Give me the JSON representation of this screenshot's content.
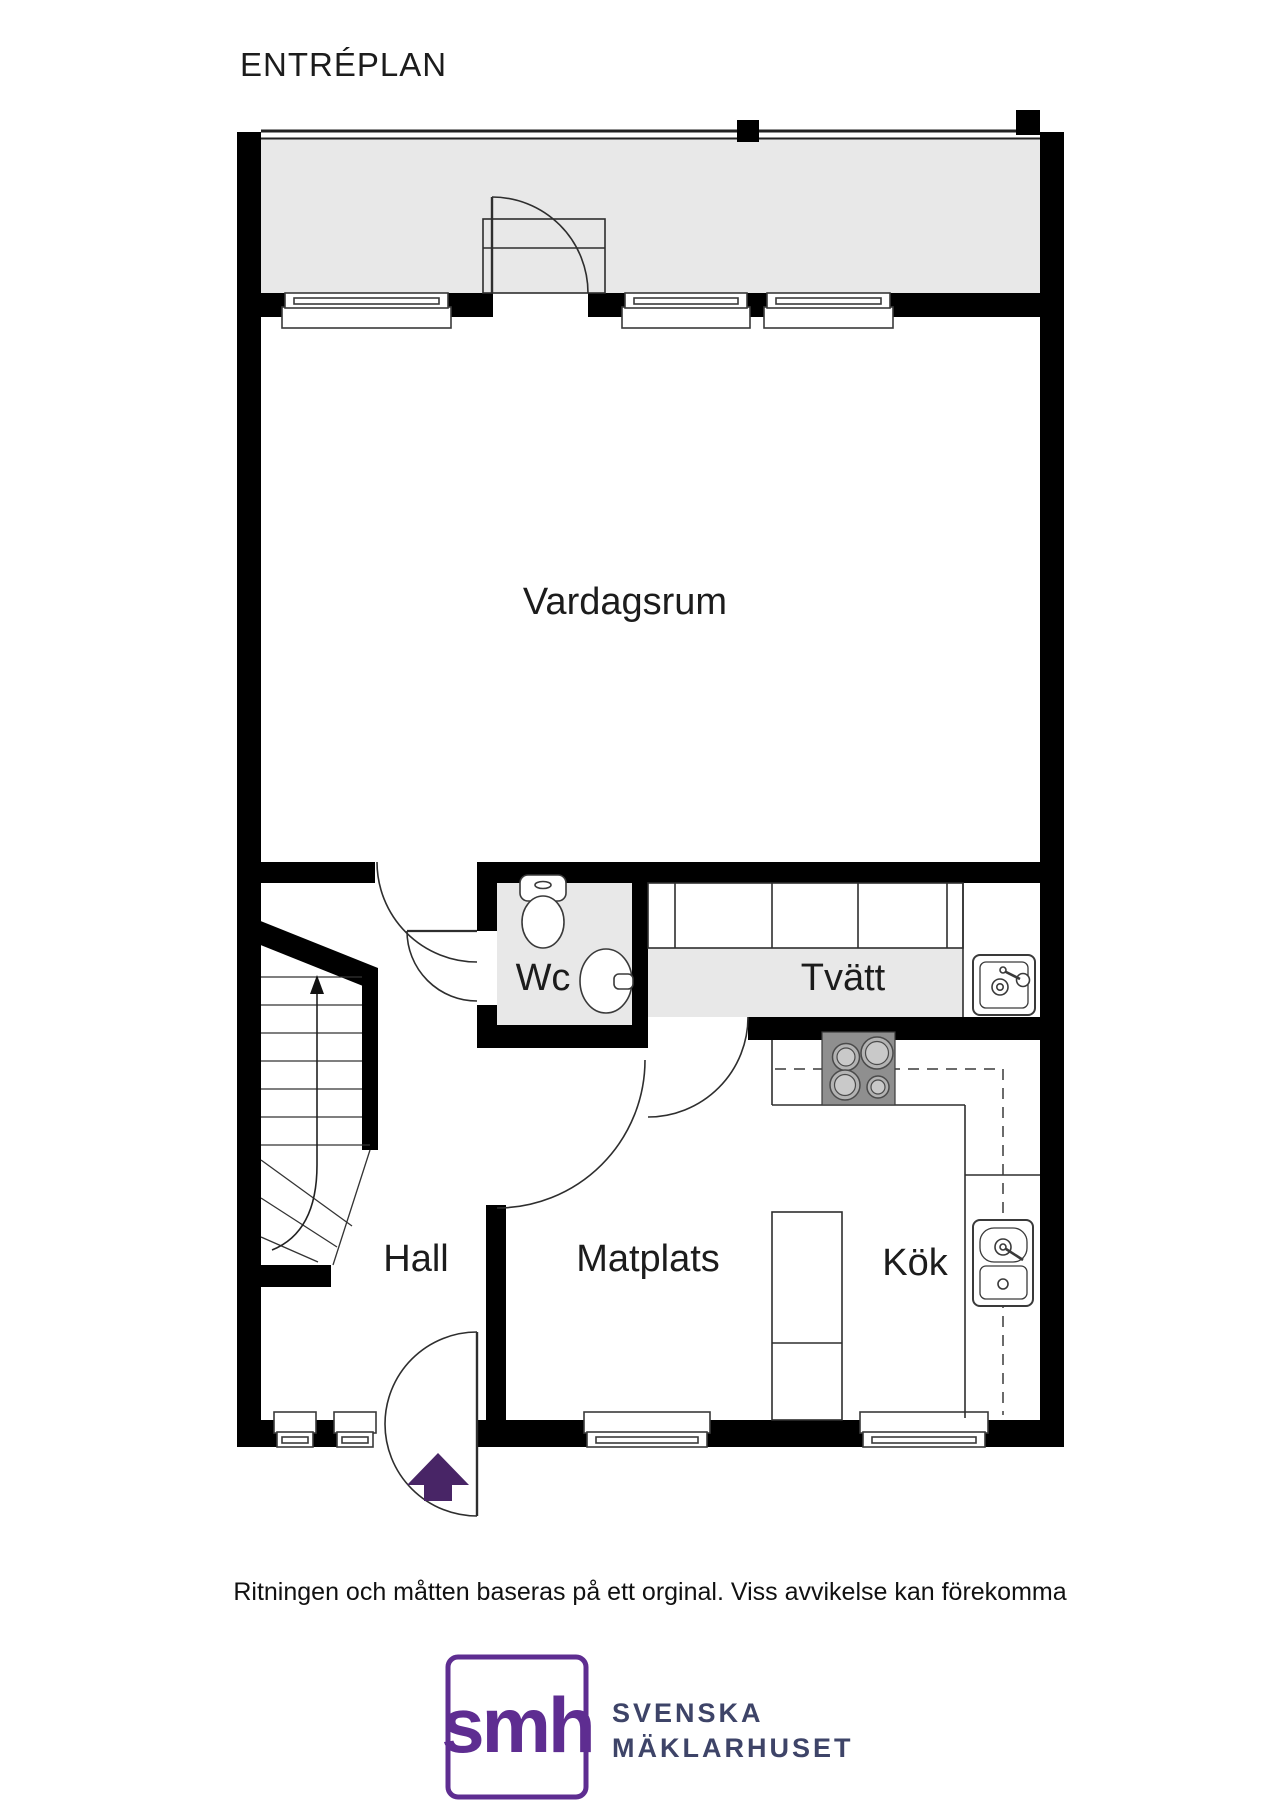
{
  "title": "ENTRÉPLAN",
  "rooms": {
    "vardagsrum": "Vardagsrum",
    "wc": "Wc",
    "tvatt": "Tvätt",
    "hall": "Hall",
    "matplats": "Matplats",
    "kok": "Kök"
  },
  "disclaimer": "Ritningen och måtten baseras på ett orginal. Viss avvikelse kan förekomma",
  "logo": {
    "monogram": "smh",
    "line1": "SVENSKA",
    "line2": "MÄKLARHUSET"
  },
  "colors": {
    "wall": "#000000",
    "floor_shaded": "#e8e8e8",
    "stove_plate": "#8f8f8f",
    "arrow_purple": "#482566",
    "brand_purple": "#5e2d91",
    "logo_text": "#3e4468"
  },
  "icons": {
    "entrance_arrow": "up-arrow",
    "stairs_direction": "up-arrow",
    "toilet": "toilet-top-view",
    "wc_sink": "round-basin",
    "laundry_sink": "square-basin",
    "kitchen_sink": "double-basin",
    "stove": "four-burner-cooktop"
  }
}
